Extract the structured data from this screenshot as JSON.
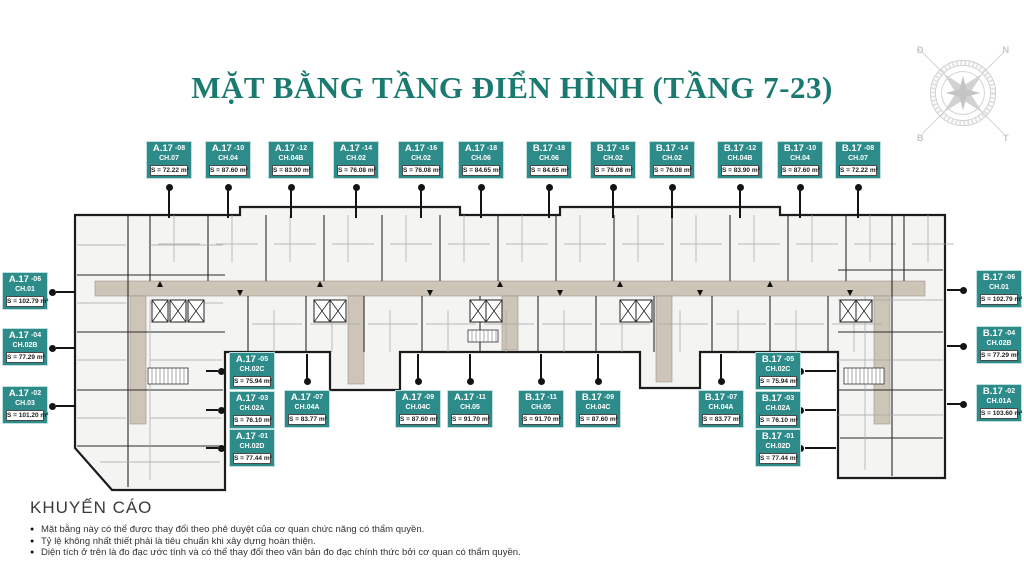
{
  "title": "MẶT BẰNG TẦNG ĐIỂN HÌNH (TẦNG 7-23)",
  "colors": {
    "accent_teal": "#1a7a70",
    "label_bg": "#2d8c8a",
    "corridor": "#cdc5b7",
    "wall": "#1c1c1c",
    "room_fill": "#f4f4f2"
  },
  "compass": {
    "tl": "Đ",
    "tr": "N",
    "bl": "B",
    "br": "T"
  },
  "units": {
    "labels": [
      {
        "group": "top-row",
        "block": "A.17",
        "no": "-08",
        "unit": "CH.07",
        "area": "S = 72.22 m²",
        "anchor": "down",
        "x": 146,
        "y": 141
      },
      {
        "group": "top-row",
        "block": "A.17",
        "no": "-10",
        "unit": "CH.04",
        "area": "S = 87.60 m²",
        "anchor": "down",
        "x": 205,
        "y": 141
      },
      {
        "group": "top-row",
        "block": "A.17",
        "no": "-12",
        "unit": "CH.04B",
        "area": "S = 83.90 m²",
        "anchor": "down",
        "x": 268,
        "y": 141
      },
      {
        "group": "top-row",
        "block": "A.17",
        "no": "-14",
        "unit": "CH.02",
        "area": "S = 76.08 m²",
        "anchor": "down",
        "x": 333,
        "y": 141
      },
      {
        "group": "top-row",
        "block": "A.17",
        "no": "-16",
        "unit": "CH.02",
        "area": "S = 76.08 m²",
        "anchor": "down",
        "x": 398,
        "y": 141
      },
      {
        "group": "top-row",
        "block": "A.17",
        "no": "-18",
        "unit": "CH.06",
        "area": "S = 84.65 m²",
        "anchor": "down",
        "x": 458,
        "y": 141
      },
      {
        "group": "top-row",
        "block": "B.17",
        "no": "-18",
        "unit": "CH.06",
        "area": "S = 84.65 m²",
        "anchor": "down",
        "x": 526,
        "y": 141
      },
      {
        "group": "top-row",
        "block": "B.17",
        "no": "-16",
        "unit": "CH.02",
        "area": "S = 76.08 m²",
        "anchor": "down",
        "x": 590,
        "y": 141
      },
      {
        "group": "top-row",
        "block": "B.17",
        "no": "-14",
        "unit": "CH.02",
        "area": "S = 76.08 m²",
        "anchor": "down",
        "x": 649,
        "y": 141
      },
      {
        "group": "top-row",
        "block": "B.17",
        "no": "-12",
        "unit": "CH.04B",
        "area": "S = 83.90 m²",
        "anchor": "down",
        "x": 717,
        "y": 141
      },
      {
        "group": "top-row",
        "block": "B.17",
        "no": "-10",
        "unit": "CH.04",
        "area": "S = 87.60 m²",
        "anchor": "down",
        "x": 777,
        "y": 141
      },
      {
        "group": "top-row",
        "block": "B.17",
        "no": "-08",
        "unit": "CH.07",
        "area": "S = 72.22 m²",
        "anchor": "down",
        "x": 835,
        "y": 141
      },
      {
        "group": "left-side",
        "block": "A.17",
        "no": "-06",
        "unit": "CH.01",
        "area": "S = 102.79 m²",
        "anchor": "left",
        "x": 2,
        "y": 272
      },
      {
        "group": "left-side",
        "block": "A.17",
        "no": "-04",
        "unit": "CH.02B",
        "area": "S = 77.29 m²",
        "anchor": "left",
        "x": 2,
        "y": 328
      },
      {
        "group": "left-side",
        "block": "A.17",
        "no": "-02",
        "unit": "CH.03",
        "area": "S = 101.20 m²",
        "anchor": "left",
        "x": 2,
        "y": 386
      },
      {
        "group": "right-side",
        "block": "B.17",
        "no": "-06",
        "unit": "CH.01",
        "area": "S = 102.79 m²",
        "anchor": "right",
        "x": 976,
        "y": 270
      },
      {
        "group": "right-side",
        "block": "B.17",
        "no": "-04",
        "unit": "CH.02B",
        "area": "S = 77.29 m²",
        "anchor": "right",
        "x": 976,
        "y": 326
      },
      {
        "group": "right-side",
        "block": "B.17",
        "no": "-02",
        "unit": "CH.01A",
        "area": "S = 103.60 m²",
        "anchor": "right",
        "x": 976,
        "y": 384
      },
      {
        "group": "bottom-left-cluster",
        "block": "A.17",
        "no": "-05",
        "unit": "CH.02C",
        "area": "S = 75.94 m²",
        "anchor": "cl",
        "x": 229,
        "y": 352
      },
      {
        "group": "bottom-left-cluster",
        "block": "A.17",
        "no": "-03",
        "unit": "CH.02A",
        "area": "S = 76.10 m²",
        "anchor": "cl",
        "x": 229,
        "y": 391
      },
      {
        "group": "bottom-left-cluster",
        "block": "A.17",
        "no": "-01",
        "unit": "CH.02D",
        "area": "S = 77.44 m²",
        "anchor": "cl",
        "x": 229,
        "y": 429
      },
      {
        "group": "bottom-row",
        "block": "A.17",
        "no": "-07",
        "unit": "CH.04A",
        "area": "S = 83.77 m²",
        "anchor": "up",
        "x": 284,
        "y": 390
      },
      {
        "group": "bottom-row",
        "block": "A.17",
        "no": "-09",
        "unit": "CH.04C",
        "area": "S = 87.60 m²",
        "anchor": "up",
        "x": 395,
        "y": 390
      },
      {
        "group": "bottom-row",
        "block": "A.17",
        "no": "-11",
        "unit": "CH.05",
        "area": "S = 91.70 m²",
        "anchor": "up",
        "x": 447,
        "y": 390
      },
      {
        "group": "bottom-row",
        "block": "B.17",
        "no": "-11",
        "unit": "CH.05",
        "area": "S = 91.70 m²",
        "anchor": "up",
        "x": 518,
        "y": 390
      },
      {
        "group": "bottom-row",
        "block": "B.17",
        "no": "-09",
        "unit": "CH.04C",
        "area": "S = 87.60 m²",
        "anchor": "up",
        "x": 575,
        "y": 390
      },
      {
        "group": "bottom-row",
        "block": "B.17",
        "no": "-07",
        "unit": "CH.04A",
        "area": "S = 83.77 m²",
        "anchor": "up",
        "x": 698,
        "y": 390
      },
      {
        "group": "bottom-right-cluster",
        "block": "B.17",
        "no": "-05",
        "unit": "CH.02C",
        "area": "S = 75.94 m²",
        "anchor": "cr",
        "x": 755,
        "y": 352
      },
      {
        "group": "bottom-right-cluster",
        "block": "B.17",
        "no": "-03",
        "unit": "CH.02A",
        "area": "S = 76.10 m²",
        "anchor": "cr",
        "x": 755,
        "y": 391
      },
      {
        "group": "bottom-right-cluster",
        "block": "B.17",
        "no": "-01",
        "unit": "CH.02D",
        "area": "S = 77.44 m²",
        "anchor": "cr",
        "x": 755,
        "y": 429
      }
    ]
  },
  "disclaimer": {
    "heading": "KHUYẾN CÁO",
    "items": [
      "Mặt bằng này có thể được thay đổi theo phê duyệt của cơ quan chức năng có thẩm quyền.",
      "Tỷ lệ không nhất thiết phải là tiêu chuẩn khi xây dựng hoàn thiện.",
      "Diện tích ở trên là đo đạc ước tính và có thể thay đổi theo văn bản đo đạc chính thức bởi cơ quan có thẩm quyền."
    ]
  }
}
